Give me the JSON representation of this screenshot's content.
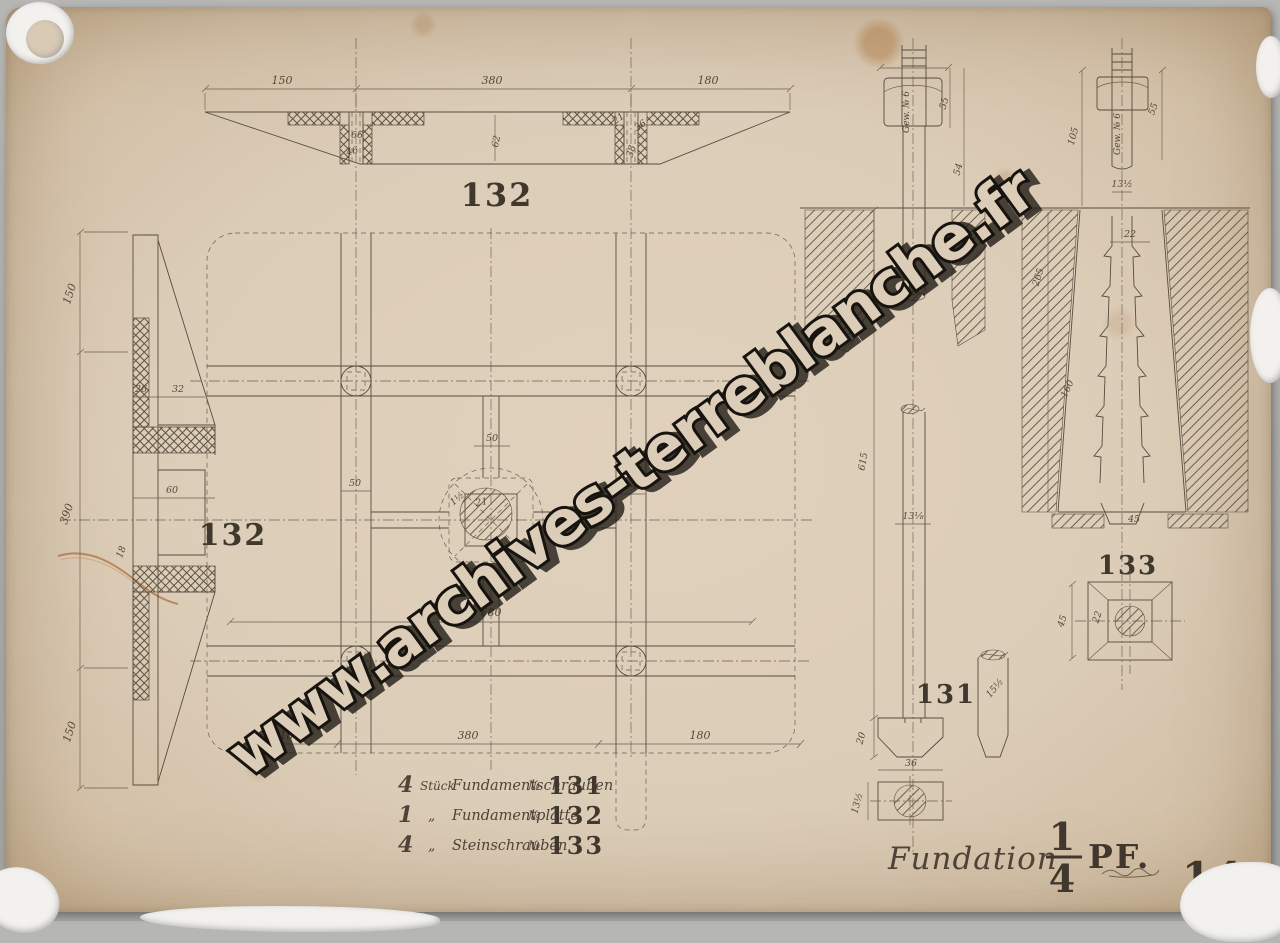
{
  "watermark": {
    "text": "www.archives-terreblanche.fr"
  },
  "top_section": {
    "label": "132",
    "dim_left": "150",
    "dim_mid": "380",
    "dim_right": "180",
    "d66": "66",
    "d46": "46",
    "d62": "62",
    "d21": "21",
    "d36": "36",
    "d38": "38"
  },
  "side_view": {
    "dim_top": "150",
    "dim_mid": "390",
    "dim_bottom": "150",
    "d26": "26",
    "d32": "32",
    "d60": "60",
    "d18": "18"
  },
  "plan": {
    "label": "132",
    "d50_beam": "50",
    "d50_center": "50",
    "d21": "21",
    "d14": "14",
    "d1half": "1½",
    "d680": "680",
    "dim_left": "180",
    "dim_mid": "380",
    "dim_right": "180"
  },
  "bolt_131": {
    "label": "131",
    "thread_note": "Gew. № 6",
    "d55": "55",
    "d54": "54",
    "d615": "615",
    "d13_8": "13⅛",
    "d20": "20",
    "d36": "36",
    "d13_2": "13½",
    "d15_2": "15½"
  },
  "stone_screw_133": {
    "label": "133",
    "thread_note": "Gew. № 6",
    "d105": "105",
    "d55": "55",
    "d13_2": "13½",
    "d22": "22",
    "d265": "265",
    "d160": "160",
    "d45": "45",
    "plan_d45": "45",
    "plan_d22": "22"
  },
  "schedule": {
    "rows": [
      {
        "qty": "4",
        "unit": "Stück",
        "item": "Fundamentschrauben",
        "no": "№",
        "num": "131"
      },
      {
        "qty": "1",
        "unit": "„",
        "item": "Fundamentplatte",
        "no": "№",
        "num": "132"
      },
      {
        "qty": "4",
        "unit": "„",
        "item": "Steinschrauben",
        "no": "№",
        "num": "133"
      }
    ]
  },
  "title_block": {
    "title": "Fundation.",
    "scale_numerator": "1",
    "scale_denominator": "4",
    "scale_unit": "PF.",
    "sheet_number": "14"
  }
}
